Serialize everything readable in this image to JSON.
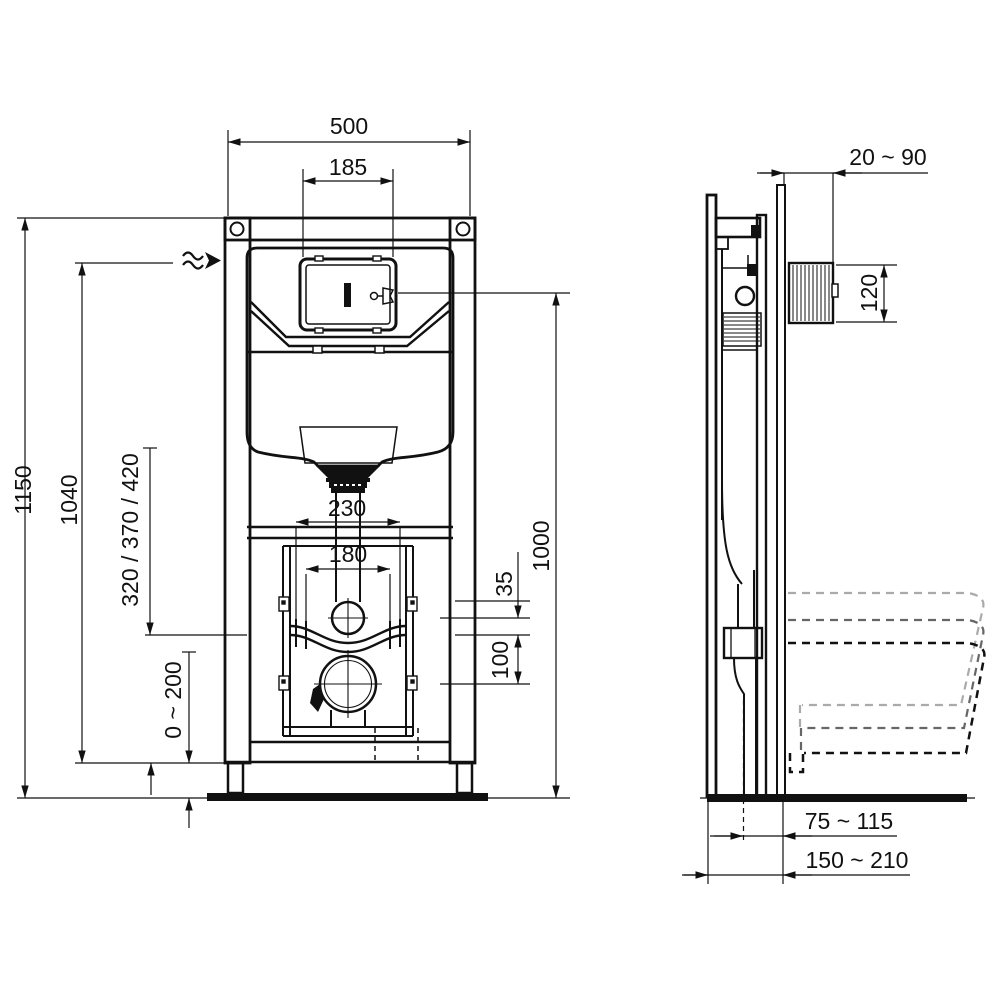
{
  "drawing": {
    "line_color": "#111111",
    "ghost_color_light": "#aaaaaa",
    "ghost_color_mid": "#666666"
  },
  "front_view": {
    "overall_width": "500",
    "plate_cutout_width": "185",
    "overall_height": "1150",
    "water_supply_height": "1040",
    "outlet_height_options": "320 / 370 / 420",
    "foot_adjust_range": "0 ~ 200",
    "flush_pipe_spacing": "230",
    "fixing_bolt_spacing": "180",
    "pipe_offset_small": "35",
    "pipe_offset_outlet": "100",
    "plate_centre_height": "1000"
  },
  "side_view": {
    "wall_finish_range": "20 ~ 90",
    "plate_box_height": "120",
    "outlet_to_wall_range": "75 ~ 115",
    "frame_depth_range": "150 ~ 210"
  }
}
